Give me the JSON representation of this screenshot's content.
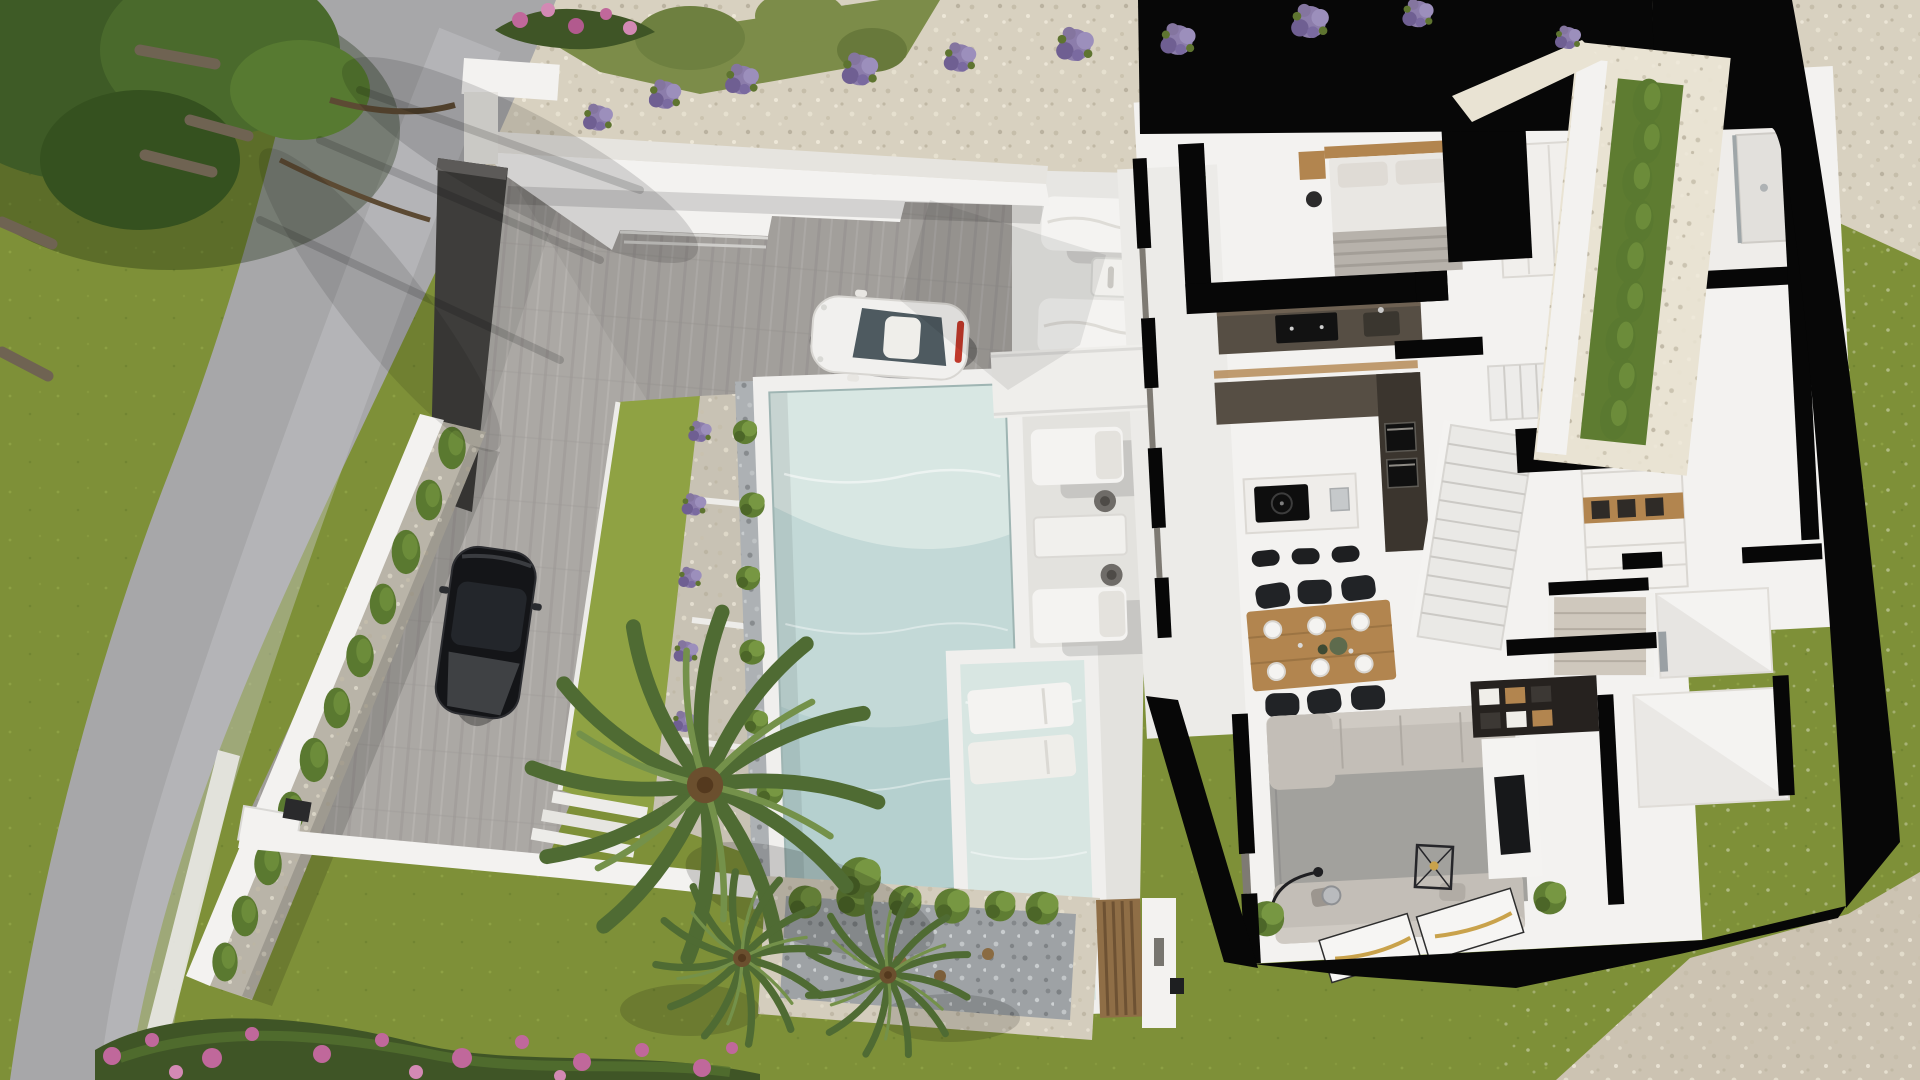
{
  "meta": {
    "type": "aerial-architectural-render",
    "subject": "modern white villa, cutaway interior floor plan, infinity pool, landscaped plot",
    "view": "top-down"
  },
  "palette": {
    "grass": "#7E9038",
    "grassLight": "#8FA243",
    "grassShade": "#5E7428",
    "olive": "#7C8C49",
    "road": "#A7A7A9",
    "roadLight": "#C6C6C8",
    "paver": "#ABA8A4",
    "gravel": "#D8D1C0",
    "gravelLight": "#E9E3D3",
    "pebble": "#9EA2A5",
    "whiteWall": "#F3F2F0",
    "wallShade": "#D9D8D5",
    "deck": "#E7E6E3",
    "coping": "#F0EFED",
    "pool": "#C3D9D7",
    "poolLight": "#DCE9E5",
    "poolDeep": "#A9C8C9",
    "shallow": "#D8E6E2",
    "cut": "#070707",
    "darkWall": "#3E3D3B",
    "hedge": "#5E7C31",
    "tree": "#3E5B26",
    "palm": "#4F6B33",
    "palmLight": "#74914A",
    "lavender": "#8C7DAB",
    "flower": "#C0689B",
    "flowerLeaf": "#3F5526",
    "wood": "#B2854F",
    "counter": "#564E44",
    "counterDark": "#3B352E",
    "sofa": "#C3BEB7",
    "rug": "#A2A19D",
    "carWhite": "#F1F0EE",
    "carBlack": "#141518",
    "accentRed": "#C0392B"
  },
  "scene": {
    "ground": [
      "asphalt road",
      "front lawn",
      "paved driveway",
      "gravel bank",
      "rear lawn",
      "gravel patches"
    ],
    "landscaping": {
      "items": [
        "pine trees",
        "fallen logs",
        "olive shrubs",
        "lavender bushes",
        "cypress hedge",
        "boxwood shrubs",
        "palm trees",
        "bougainvillea flower bed",
        "pebble planter with shrubs"
      ],
      "lavender_count": 10,
      "cypress_count": 11,
      "palm_count": 3
    },
    "vehicles": [
      {
        "name": "white-sports-car",
        "color": "white",
        "location": "upper driveway"
      },
      {
        "name": "black-sports-car",
        "color": "black",
        "location": "lower driveway"
      }
    ],
    "pool": {
      "name": "infinity-pool",
      "water": "pale turquoise",
      "features": [
        "tanning shelf with 2 in-water loungers",
        "pebble border strip"
      ]
    },
    "outdoor_furniture": {
      "terrace_loungers": 2,
      "poolside_loungers": 2,
      "side_tables": 2,
      "poufs": 2
    },
    "villa": {
      "style": "white cutaway floor plan with black sectioned walls and glazed facade",
      "rooms": [
        {
          "name": "master-bedroom",
          "furniture": [
            "double bed",
            "wood headboard",
            "2 nightstands",
            "pendant lamps",
            "wardrobe with wood shelving"
          ]
        },
        {
          "name": "bathroom",
          "furniture": [
            "vanity",
            "mirror",
            "walk-in shower",
            "wc"
          ]
        },
        {
          "name": "kitchen",
          "furniture": [
            "dark galley counter with cooktop",
            "tall oven column",
            "island with induction hob",
            "3 bar stools"
          ]
        },
        {
          "name": "dining-area",
          "furniture": [
            "wood dining table",
            "6 black chairs",
            "table setting"
          ]
        },
        {
          "name": "living-room",
          "furniture": [
            "2 grey sofas",
            "grey rug",
            "wire coffee table",
            "arc floor lamp",
            "TV partition",
            "dark media wall",
            "indoor plants",
            "2 white rugs"
          ]
        },
        {
          "name": "staircase",
          "furniture": [
            "L-shaped stair with landing"
          ]
        },
        {
          "name": "dressing-hall",
          "furniture": [
            "drawer unit with wood niche",
            "steps down"
          ]
        },
        {
          "name": "storage-rooms",
          "furniture": []
        }
      ]
    },
    "boundaries": [
      "white stepped retaining wall",
      "white perimeter wall",
      "anthracite entry wall",
      "timber slat gate",
      "gate pillar with lamp"
    ]
  }
}
